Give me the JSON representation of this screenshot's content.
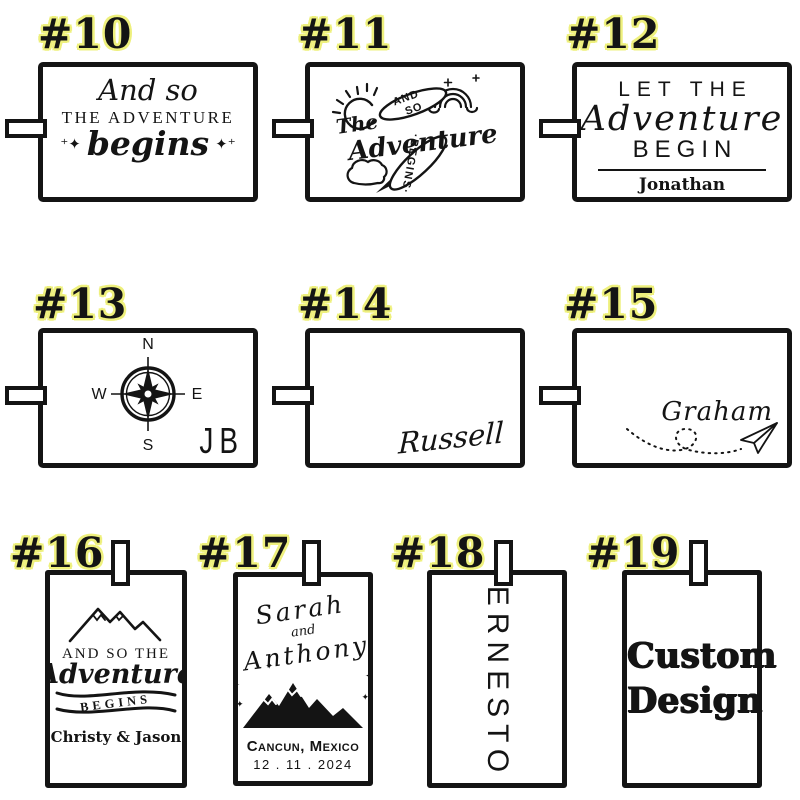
{
  "page": {
    "background": "#ffffff",
    "ink": "#141414",
    "label_text_color": "#141414",
    "label_halo_color": "#eef07d"
  },
  "tags": [
    {
      "label": "#10",
      "design": {
        "line1": "And so",
        "line2": "THE ADVENTURE",
        "line3": "begins",
        "sparkle_left": "⁺✦",
        "sparkle_right": "✦⁺"
      }
    },
    {
      "label": "#11",
      "design": {
        "and": "AND",
        "so": "SO",
        "the": "The",
        "adventure": "Adventure",
        "begins": "·BEGINS·"
      }
    },
    {
      "label": "#12",
      "design": {
        "line1": "LET THE",
        "line2": "Adventure",
        "line3": "BEGIN",
        "name": "Jonathan"
      }
    },
    {
      "label": "#13",
      "design": {
        "north": "N",
        "south": "S",
        "east": "E",
        "west": "W",
        "initials": "JB"
      }
    },
    {
      "label": "#14",
      "design": {
        "name": "Russell"
      }
    },
    {
      "label": "#15",
      "design": {
        "name": "Graham"
      }
    },
    {
      "label": "#16",
      "design": {
        "line1": "AND SO THE",
        "line2": "Adventure",
        "line3": "BEGINS",
        "names": "Christy & Jason"
      }
    },
    {
      "label": "#17",
      "design": {
        "name1": "Sarah",
        "conj": "and",
        "name2": "Anthony",
        "location": "Cancun, Mexico",
        "date": "12 . 11 . 2024",
        "sparkle": "✦"
      }
    },
    {
      "label": "#18",
      "design": {
        "name": "ERNESTO"
      }
    },
    {
      "label": "#19",
      "design": {
        "line1": "Custom",
        "line2": "Design"
      }
    }
  ]
}
